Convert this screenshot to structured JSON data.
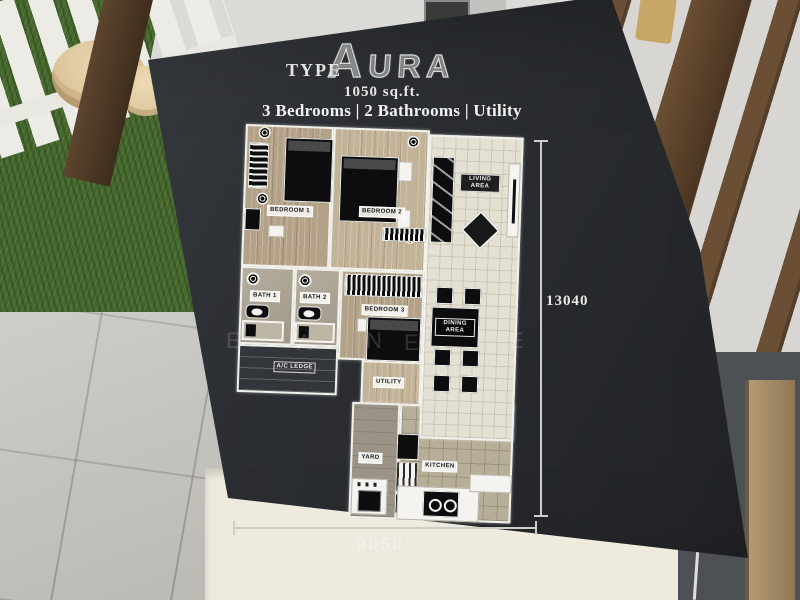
{
  "board": {
    "title_prefix": "TYPE",
    "title_logo": "AURA",
    "area_label": "1050 sq.ft.",
    "features_label": "3 Bedrooms | 2 Bathrooms | Utility",
    "dimension_vertical": "13040",
    "dimension_horizontal": "9050",
    "watermark_letters": [
      "E",
      "A",
      "N",
      "E",
      "E"
    ]
  },
  "plan": {
    "rooms": [
      {
        "id": "bedroom-1",
        "label": "BEDROOM 1",
        "floor": "wood"
      },
      {
        "id": "bedroom-2",
        "label": "BEDROOM 2",
        "floor": "wood"
      },
      {
        "id": "bedroom-3",
        "label": "BEDROOM 3",
        "floor": "wood"
      },
      {
        "id": "bath-1",
        "label": "BATH 1",
        "floor": "stone"
      },
      {
        "id": "bath-2",
        "label": "BATH 2",
        "floor": "stone"
      },
      {
        "id": "living-area",
        "label": "LIVING AREA",
        "floor": "tile"
      },
      {
        "id": "dining-area",
        "label": "DINING AREA",
        "floor": "tile"
      },
      {
        "id": "ac-ledge",
        "label": "A/C LEDGE",
        "floor": "concrete"
      },
      {
        "id": "utility",
        "label": "UTILITY",
        "floor": "wood"
      },
      {
        "id": "yard",
        "label": "YARD",
        "floor": "stone"
      },
      {
        "id": "kitchen",
        "label": "KITCHEN",
        "floor": "tile"
      }
    ]
  },
  "colors": {
    "board_dark": "#2c2f33",
    "grass": "#46682e",
    "wood_floor": "#b3a288",
    "tile_light": "#e5e1d2",
    "accent_red_box": "#b23333",
    "dimension_line": "#cdcdcb"
  }
}
